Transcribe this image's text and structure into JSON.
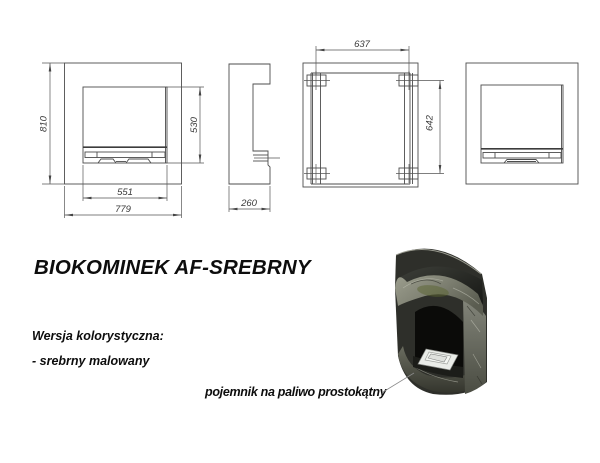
{
  "page": {
    "background": "#ffffff",
    "line_color": "#4d4d4d",
    "dim_text_color": "#3a3a3a"
  },
  "drawing": {
    "dimensions": {
      "overall_height": "810",
      "opening_height": "530",
      "opening_width": "551",
      "overall_width": "779",
      "depth": "260",
      "mount_spacing_width": "637",
      "mount_spacing_height": "642"
    }
  },
  "info": {
    "title": "BIOKOMINEK AF-SREBRNY",
    "color_section_label": "Wersja kolorystyczna:",
    "color_variant": "- srebrny malowany",
    "fuel_container_callout": "pojemnik na paliwo prostokątny"
  },
  "render_colors": {
    "body_dark": "#2e2f2a",
    "marble_light": "#9c9e8e",
    "marble_dark": "#4a4c42",
    "interior_black": "#0b0b09",
    "tray_white": "#eaece8",
    "glint_olive": "#5a6430"
  }
}
